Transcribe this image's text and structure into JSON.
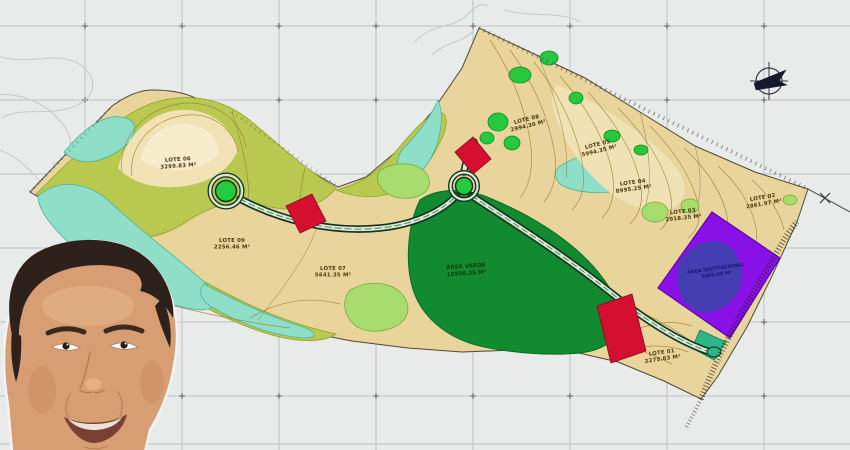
{
  "image": {
    "description": "Topographic land-subdivision site plan (loteamento) with lot areas, roads, roundabouts, preservation zones and an overlaid presenter portrait photo",
    "north_symbol": "north-arrow"
  },
  "map": {
    "lots": [
      {
        "name": "LOTE 01",
        "area": "2275.83 M²"
      },
      {
        "name": "LOTE 02",
        "area": "2861.97 M²"
      },
      {
        "name": "LOTE 03",
        "area": "2918.35 M²"
      },
      {
        "name": "LOTE 04",
        "area": "8995.25 M²"
      },
      {
        "name": "LOTE 05",
        "area": "5994.35 M²"
      },
      {
        "name": "LOTE 06",
        "area": "3299.83 M²"
      },
      {
        "name": "LOTE 07",
        "area": "5641.35 M²"
      },
      {
        "name": "LOTE 08",
        "area": "2994.30 M²"
      },
      {
        "name": "LOTE 09",
        "area": "2256.46 M²"
      }
    ],
    "zones": [
      {
        "name": "ÁREA VERDE",
        "area": "10956.35 M²"
      },
      {
        "name": "ÁREA INSTITUCIONAL",
        "area": "5000.00 M²"
      }
    ],
    "colors": {
      "background": "#e9ebea",
      "grid": "#b6c3cb",
      "lot_fill": "#e9d49c",
      "wetland_cyan": "#8fdec8",
      "vegetation_green": "#27c840",
      "forest_green": "#128a30",
      "olive_band": "#b9c84f",
      "institutional_purple": "#8a10e8",
      "highlight_red": "#d50f2f",
      "road_fill": "#d8e9d5"
    }
  }
}
